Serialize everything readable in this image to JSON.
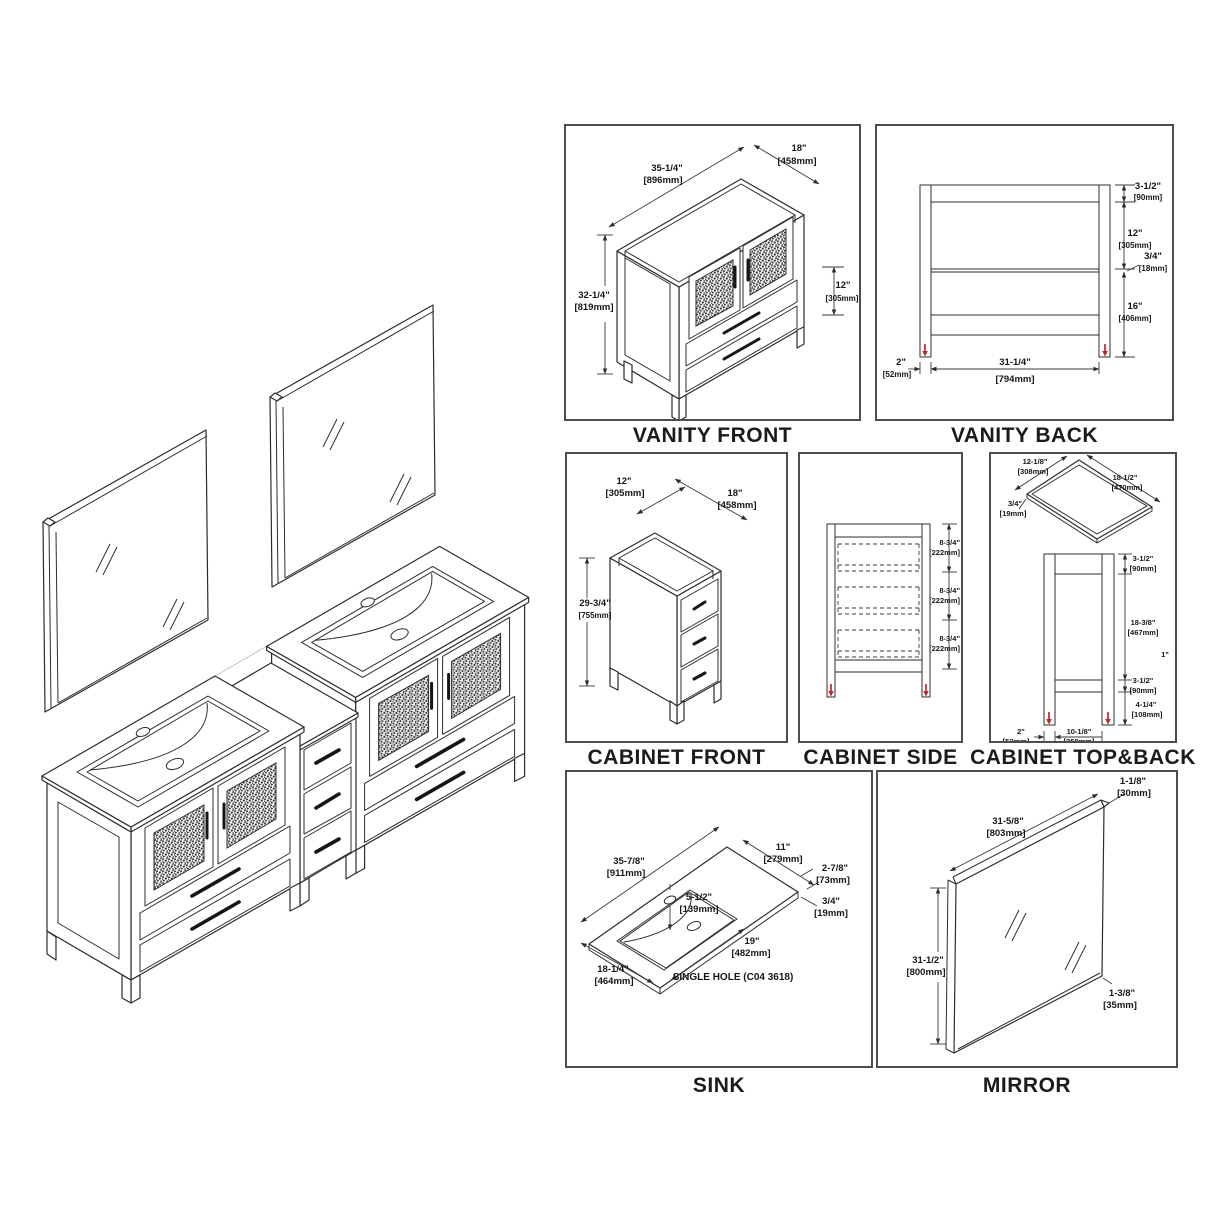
{
  "document": {
    "type": "vanity-set-specification-drawing"
  },
  "colors": {
    "line": "#2d2d2d",
    "dim_text": "#161616",
    "accent_red": "#c0272d",
    "panel_border": "#4d4d4d",
    "faint": "#c2c2c2"
  },
  "panels": {
    "vanity_front": {
      "title": "VANITY FRONT",
      "width_in": "35-1/4\"",
      "width_mm": "[896mm]",
      "depth_in": "18\"",
      "depth_mm": "[458mm]",
      "height_in": "32-1/4\"",
      "height_mm": "[819mm]",
      "drawer_in": "12\"",
      "drawer_mm": "[305mm]"
    },
    "vanity_back": {
      "title": "VANITY BACK",
      "top_in": "3-1/2\"",
      "top_mm": "[90mm]",
      "mid_in": "12\"",
      "mid_mm": "[305mm]",
      "rail_in": "3/4\"",
      "rail_mm": "[18mm]",
      "low_in": "16\"",
      "low_mm": "[406mm]",
      "leg_in": "2\"",
      "leg_mm": "[52mm]",
      "span_in": "31-1/4\"",
      "span_mm": "[794mm]"
    },
    "cabinet_front": {
      "title": "CABINET FRONT",
      "width_in": "12\"",
      "width_mm": "[305mm]",
      "depth_in": "18\"",
      "depth_mm": "[458mm]",
      "height_in": "29-3/4\"",
      "height_mm": "[755mm]"
    },
    "cabinet_side": {
      "title": "CABINET SIDE",
      "d1_in": "8-3/4\"",
      "d1_mm": "[222mm]",
      "d2_in": "8-3/4\"",
      "d2_mm": "[222mm]",
      "d3_in": "8-3/4\"",
      "d3_mm": "[222mm]"
    },
    "cabinet_top_back": {
      "title": "CABINET TOP&BACK",
      "top_w_in": "12-1/8\"",
      "top_w_mm": "[308mm]",
      "top_d_in": "18-1/2\"",
      "top_d_mm": "[470mm]",
      "thk_in": "3/4\"",
      "thk_mm": "[19mm]",
      "b_top_in": "3-1/2\"",
      "b_top_mm": "[90mm]",
      "b_mid_in": "18-3/8\"",
      "b_mid_mm": "[467mm]",
      "b_low_in": "3-1/2\"",
      "b_low_mm": "[90mm]",
      "b_leg_in": "4-1/4\"",
      "b_leg_mm": "[108mm]",
      "b_legw_in": "2\"",
      "b_legw_mm": "[52mm]",
      "b_span_in": "10-1/8\"",
      "b_span_mm": "[258mm]",
      "stray": "1\""
    },
    "sink": {
      "title": "SINK",
      "w_in": "35-7/8\"",
      "w_mm": "[911mm]",
      "bk_in": "11\"",
      "bk_mm": "[279mm]",
      "r_in": "2-7/8\"",
      "r_mm": "[73mm]",
      "thk_in": "3/4\"",
      "thk_mm": "[19mm]",
      "f_in": "5-1/2\"",
      "f_mm": "[139mm]",
      "bw_in": "19\"",
      "bw_mm": "[482mm]",
      "d_in": "18-1/4\"",
      "d_mm": "[464mm]",
      "note": "SINGLE HOLE (C04 3618)"
    },
    "mirror": {
      "title": "MIRROR",
      "t_in": "1-1/8\"",
      "t_mm": "[30mm]",
      "w_in": "31-5/8\"",
      "w_mm": "[803mm]",
      "h_in": "31-1/2\"",
      "h_mm": "[800mm]",
      "f_in": "1-3/8\"",
      "f_mm": "[35mm]"
    }
  }
}
